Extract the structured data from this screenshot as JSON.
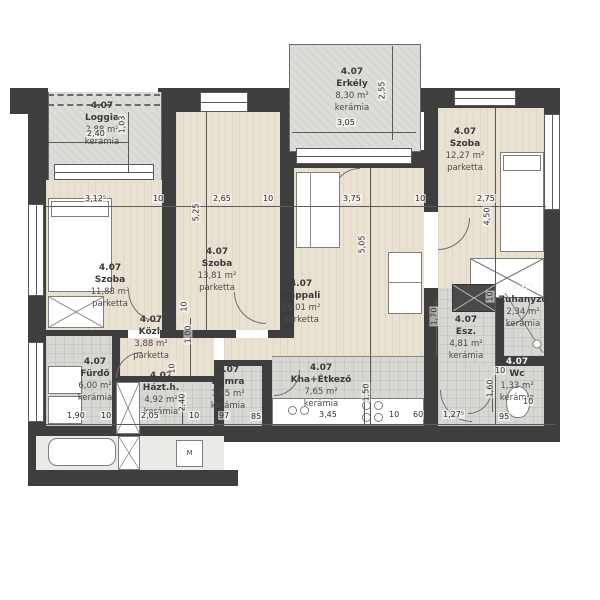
{
  "unit_number": "4.07",
  "rooms": [
    {
      "id": "loggia",
      "unit": "4.07",
      "name": "Loggia",
      "area": "2,88 m²",
      "floor": "kerámia"
    },
    {
      "id": "erkely",
      "unit": "4.07",
      "name": "Erkély",
      "area": "8,30 m²",
      "floor": "kerámia"
    },
    {
      "id": "szoba-right",
      "unit": "4.07",
      "name": "Szoba",
      "area": "12,27 m²",
      "floor": "parketta"
    },
    {
      "id": "szoba-left",
      "unit": "4.07",
      "name": "Szoba",
      "area": "11,88 m²",
      "floor": "parketta"
    },
    {
      "id": "szoba-middle",
      "unit": "4.07",
      "name": "Szoba",
      "area": "13,81 m²",
      "floor": "parketta"
    },
    {
      "id": "nappali",
      "unit": "4.07",
      "name": "Nappali",
      "area": "16,01 m²",
      "floor": "parketta"
    },
    {
      "id": "kozl",
      "unit": "4.07",
      "name": "Közl.",
      "area": "3,88 m²",
      "floor": "parketta"
    },
    {
      "id": "furdo",
      "unit": "4.07",
      "name": "Fürdő",
      "area": "6,00 m²",
      "floor": "kerámia"
    },
    {
      "id": "hazth",
      "unit": "4.07",
      "name": "Házt.h.",
      "area": "4,92 m²",
      "floor": "kerámia"
    },
    {
      "id": "kamra",
      "unit": "4.07",
      "name": "Kamra",
      "area": "1,85 m²",
      "floor": "kerámia"
    },
    {
      "id": "kha-etkezo",
      "unit": "4.07",
      "name": "Kha+Étkező",
      "area": "7,65 m²",
      "floor": "kerámia"
    },
    {
      "id": "esz",
      "unit": "4.07",
      "name": "Esz.",
      "area": "4,81 m²",
      "floor": "kerámia"
    },
    {
      "id": "zuhanyzo",
      "unit": "4.07",
      "name": "Zuhanyzó",
      "area": "2,34 m²",
      "floor": "kerámia"
    },
    {
      "id": "wc",
      "unit": "4.07",
      "name": "Wc",
      "area": "1,33 m²",
      "floor": "kerámia"
    }
  ],
  "appliances": {
    "washing_machine": "M"
  },
  "dimensions": [
    {
      "t": "3,12⁵",
      "x": 84,
      "y": 194
    },
    {
      "t": "10",
      "x": 152,
      "y": 194
    },
    {
      "t": "2,65",
      "x": 212,
      "y": 194
    },
    {
      "t": "10",
      "x": 262,
      "y": 194
    },
    {
      "t": "3,75",
      "x": 342,
      "y": 194
    },
    {
      "t": "10",
      "x": 414,
      "y": 194
    },
    {
      "t": "2,75",
      "x": 476,
      "y": 194
    },
    {
      "t": "5,25",
      "x": 186,
      "y": 208,
      "r": 1
    },
    {
      "t": "5,05",
      "x": 352,
      "y": 240,
      "r": 1
    },
    {
      "t": "4,50",
      "x": 477,
      "y": 212,
      "r": 1
    },
    {
      "t": "2,40",
      "x": 86,
      "y": 129
    },
    {
      "t": "1,03",
      "x": 112,
      "y": 120,
      "r": 1
    },
    {
      "t": "3,05",
      "x": 336,
      "y": 118
    },
    {
      "t": "2,55",
      "x": 372,
      "y": 86,
      "r": 1
    },
    {
      "t": "10",
      "x": 178,
      "y": 302,
      "r": 1
    },
    {
      "t": "1,00",
      "x": 178,
      "y": 330,
      "r": 1
    },
    {
      "t": "10",
      "x": 166,
      "y": 364,
      "r": 1
    },
    {
      "t": "1,90",
      "x": 66,
      "y": 411
    },
    {
      "t": "10",
      "x": 100,
      "y": 411
    },
    {
      "t": "2,05",
      "x": 140,
      "y": 411
    },
    {
      "t": "2,40",
      "x": 172,
      "y": 398,
      "r": 1
    },
    {
      "t": "10",
      "x": 188,
      "y": 411
    },
    {
      "t": "97",
      "x": 218,
      "y": 411
    },
    {
      "t": "85",
      "x": 250,
      "y": 412
    },
    {
      "t": "3,45",
      "x": 318,
      "y": 410
    },
    {
      "t": "1,50",
      "x": 356,
      "y": 388,
      "r": 1
    },
    {
      "t": "10",
      "x": 388,
      "y": 410
    },
    {
      "t": "60",
      "x": 412,
      "y": 410
    },
    {
      "t": "1,27⁵",
      "x": 442,
      "y": 410
    },
    {
      "t": "1,70",
      "x": 424,
      "y": 312,
      "r": 1
    },
    {
      "t": "10",
      "x": 484,
      "y": 292,
      "r": 1
    },
    {
      "t": "10",
      "x": 494,
      "y": 366
    },
    {
      "t": "1,60",
      "x": 480,
      "y": 384,
      "r": 1
    },
    {
      "t": "95",
      "x": 498,
      "y": 412
    },
    {
      "t": "10",
      "x": 522,
      "y": 397
    }
  ]
}
